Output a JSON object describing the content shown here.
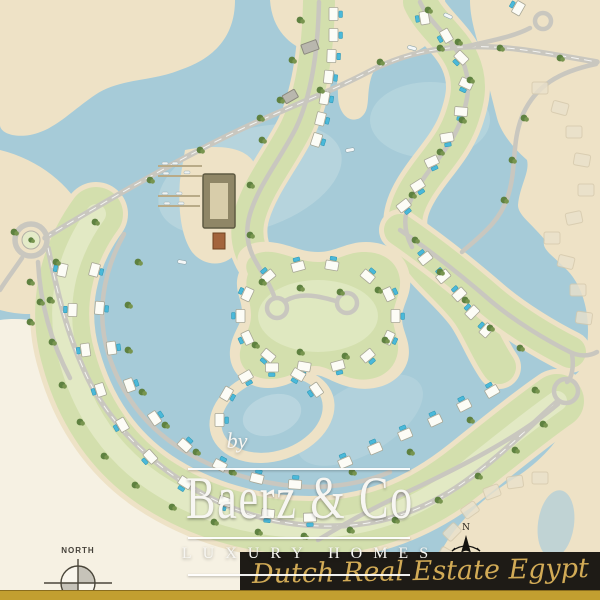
{
  "branding": {
    "prefix": "by",
    "name": "Baerz & Co",
    "tagline": "LUXURY HOMES",
    "agency": "Dutch Real Estate Egypt"
  },
  "compass": {
    "north_label": "NORTH",
    "rose_label": "N"
  },
  "map_features": [
    "lagoon",
    "beaches",
    "villa rows with pools",
    "central island with loop road",
    "marina docks",
    "clubhouse",
    "roundabout",
    "spine roads",
    "future-phase plots",
    "pond"
  ],
  "colors": {
    "water": "#a6cbd8",
    "water_light": "#c9e0e5",
    "sand": "#eee2c6",
    "sand_pale": "#f6f1e3",
    "green_band": "#d3dfad",
    "green_light": "#e4ebc8",
    "tree": "#5e8140",
    "tree_light": "#78954f",
    "road": "#c9c7bf",
    "house": "#fcfcf6",
    "pool": "#4ab9da",
    "banner_bg": "#1e1b16",
    "gold_stripe": "#c29f30",
    "gold_text": "#d2ab56",
    "text_white": "#f7f6f2"
  }
}
